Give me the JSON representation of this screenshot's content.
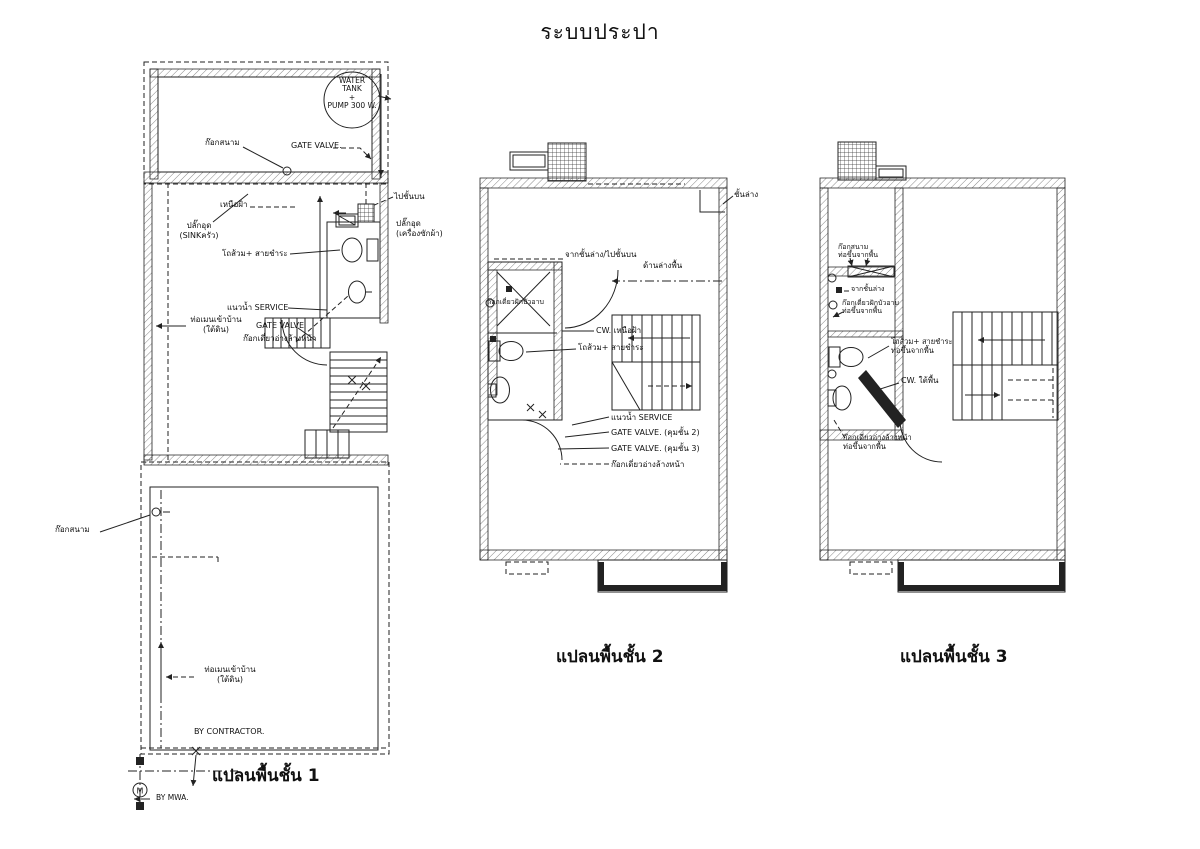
{
  "title": "ระบบประปา",
  "colors": {
    "line": "#222222",
    "background": "#ffffff"
  },
  "plan1": {
    "caption": "แปลนพื้นชั้น 1",
    "labels": {
      "water_tank": "WATER\nTANK\n+\nPUMP 300 W.",
      "garden_tap_top": "ก๊อกสนาม",
      "gate_valve_top": "GATE VALVE.",
      "above_ceiling": "เหนือฝ้า",
      "to_upper_floor": "ไปชั้นบน",
      "plug_sink": "ปลั๊กอุด\n(SINKครัว)",
      "plug_washer": "ปลั๊กอุด\n(เครื่องซักผ้า)",
      "toilet_spray": "โถส้วม+ สายชำระ",
      "service_line": "แนวน้ำ SERVICE",
      "main_pipe_mid": "ท่อเมนเข้าบ้าน\n(ใต้ดิน)",
      "gate_valve_mid": "GATE VALVE",
      "basin_tap": "ก๊อกเดี่ยวอ่างล้างหน้า",
      "garden_tap_left": "ก๊อกสนาม",
      "main_pipe_bottom": "ท่อเมนเข้าบ้าน\n(ใต้ดิน)",
      "by_contractor": "BY CONTRACTOR.",
      "by_mwa": "BY MWA.",
      "meter_letter": "M"
    }
  },
  "plan2": {
    "caption": "แปลนพื้นชั้น 2",
    "labels": {
      "lower_floor": "ชั้นล่าง",
      "from_lower_to_upper": "จากชั้นล่าง/ไปชั้นบน",
      "under_floor": "ด้านล่างพื้น",
      "shower_tap": "ก๊อกเดี่ยวฝักบัวอาบ",
      "cw_above_ceiling": "CW. เหนือฝ้า",
      "toilet_spray": "โถส้วม+ สายชำระ",
      "service_line": "แนวน้ำ SERVICE",
      "gate_valve_2": "GATE VALVE. (คุมชั้น 2)",
      "gate_valve_3": "GATE VALVE. (คุมชั้น 3)",
      "basin_tap": "ก๊อกเดี่ยวอ่างล้างหน้า"
    }
  },
  "plan3": {
    "caption": "แปลนพื้นชั้น 3",
    "labels": {
      "garden_tap": "ก๊อกสนาม\nท่อขึ้นจากพื้น",
      "from_lower": "จากชั้นล่าง",
      "shower_tap": "ก๊อกเดี่ยวฝักบัวอาบ\nท่อขึ้นจากพื้น",
      "toilet_spray": "โถส้วม+ สายชำระ\nท่อขึ้นจากพื้น",
      "cw_under_floor": "CW. ใต้พื้น",
      "basin_tap": "ก๊อกเดี่ยวอ่างล้างหน้า\nท่อขึ้นจากพื้น"
    }
  }
}
